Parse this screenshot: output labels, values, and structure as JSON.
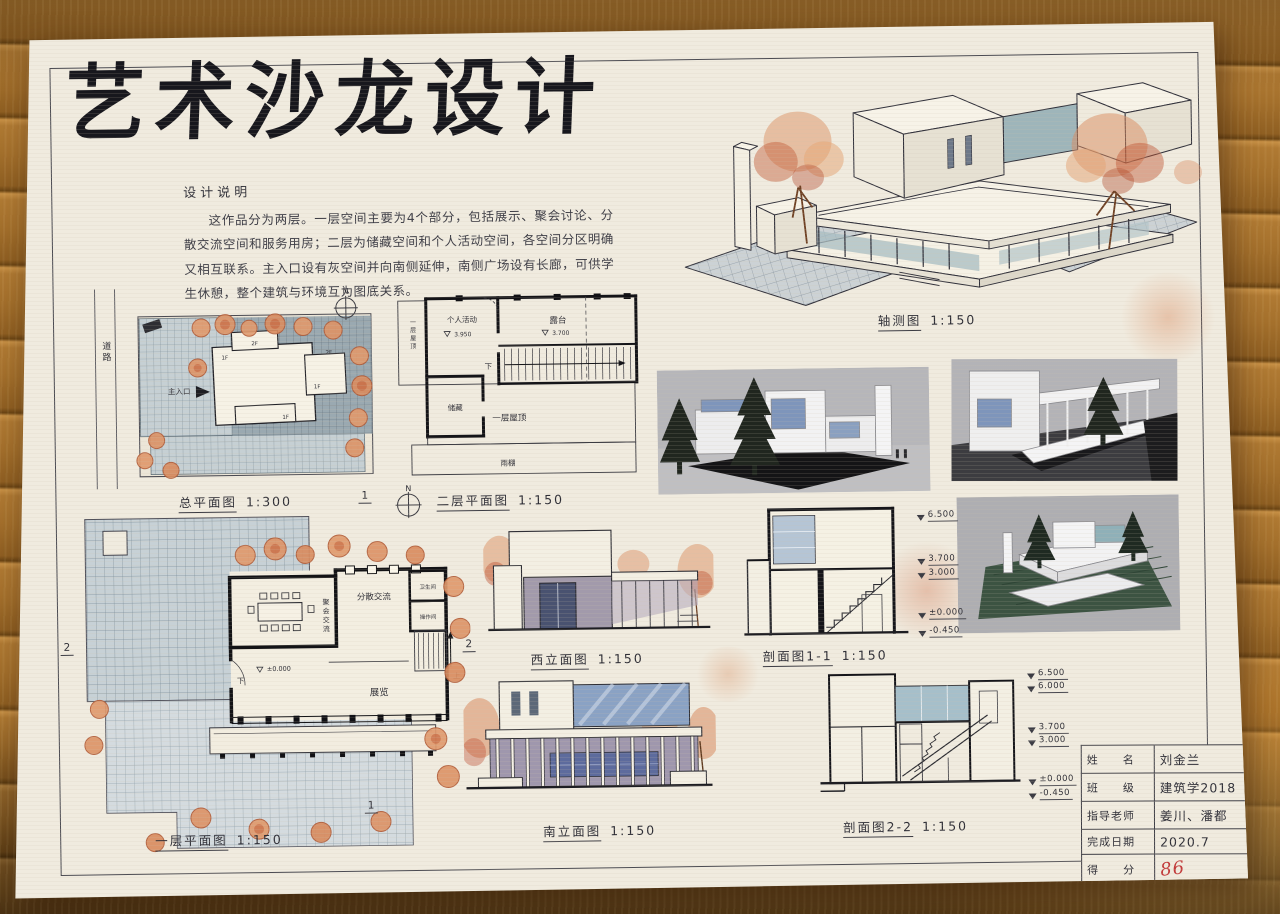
{
  "colors": {
    "paper": "#f0ebdf",
    "ink": "#2b2b33",
    "wood": "#a9722f",
    "score_red": "#c23a3a",
    "paving_blue": "#c6d0d4",
    "tree_orange": "#dd9468",
    "glass_blue": "#8fa7c6",
    "render_background": "#b6b6ba"
  },
  "board": {
    "title": "艺术沙龙设计",
    "notes": {
      "heading": "设计说明",
      "body": "这作品分为两层。一层空间主要为4个部分，包括展示、聚会讨论、分散交流空间和服务用房；二层为储藏空间和个人活动空间，各空间分区明确又相互联系。主入口设有灰空间并向南侧延伸，南侧广场设有长廊，可供学生休憩，整个建筑与环境互为图底关系。"
    },
    "site_plan": {
      "caption": "总平面图",
      "scale": "1:300",
      "road": "道路",
      "north": "N",
      "entrance": "主入口",
      "tag_1f": "1F",
      "tag_2f": "2F"
    },
    "floor2": {
      "caption": "二层平面图",
      "scale": "1:150",
      "north": "N",
      "room_personal": "个人活动",
      "level_personal": "3.950",
      "room_terrace": "露台",
      "level_terrace": "3.700",
      "down": "下",
      "room_storage": "储藏",
      "roof_label": "一层屋顶",
      "roof_side_label": "一层屋顶",
      "canopy": "雨棚"
    },
    "axon": {
      "caption": "轴测图",
      "scale": "1:150"
    },
    "floor1": {
      "caption": "一层平面图",
      "scale": "1:150",
      "room_meeting": "聚会交流",
      "room_dispersed": "分散交流",
      "room_toilet": "卫生间",
      "room_operation": "操作间",
      "room_exhibition": "展览",
      "up": "上",
      "down": "下",
      "level_zero": "±0.000",
      "mark_1": "1",
      "mark_2": "2"
    },
    "west_elevation": {
      "caption": "西立面图",
      "scale": "1:150"
    },
    "section_1_1": {
      "caption": "剖面图1-1",
      "scale": "1:150",
      "levels": [
        "6.500",
        "3.700",
        "3.000",
        "±0.000",
        "-0.450"
      ]
    },
    "south_elevation": {
      "caption": "南立面图",
      "scale": "1:150"
    },
    "section_2_2": {
      "caption": "剖面图2-2",
      "scale": "1:150",
      "levels": [
        "6.500",
        "6.000",
        "3.700",
        "3.000",
        "±0.000",
        "-0.450"
      ]
    },
    "title_block": {
      "rows": [
        {
          "label": "姓　　名",
          "value": "刘金兰"
        },
        {
          "label": "班　　级",
          "value": "建筑学2018"
        },
        {
          "label": "指导老师",
          "value": "姜川、潘都"
        },
        {
          "label": "完成日期",
          "value": "2020.7"
        },
        {
          "label": "得　　分",
          "value": "86"
        }
      ]
    }
  }
}
